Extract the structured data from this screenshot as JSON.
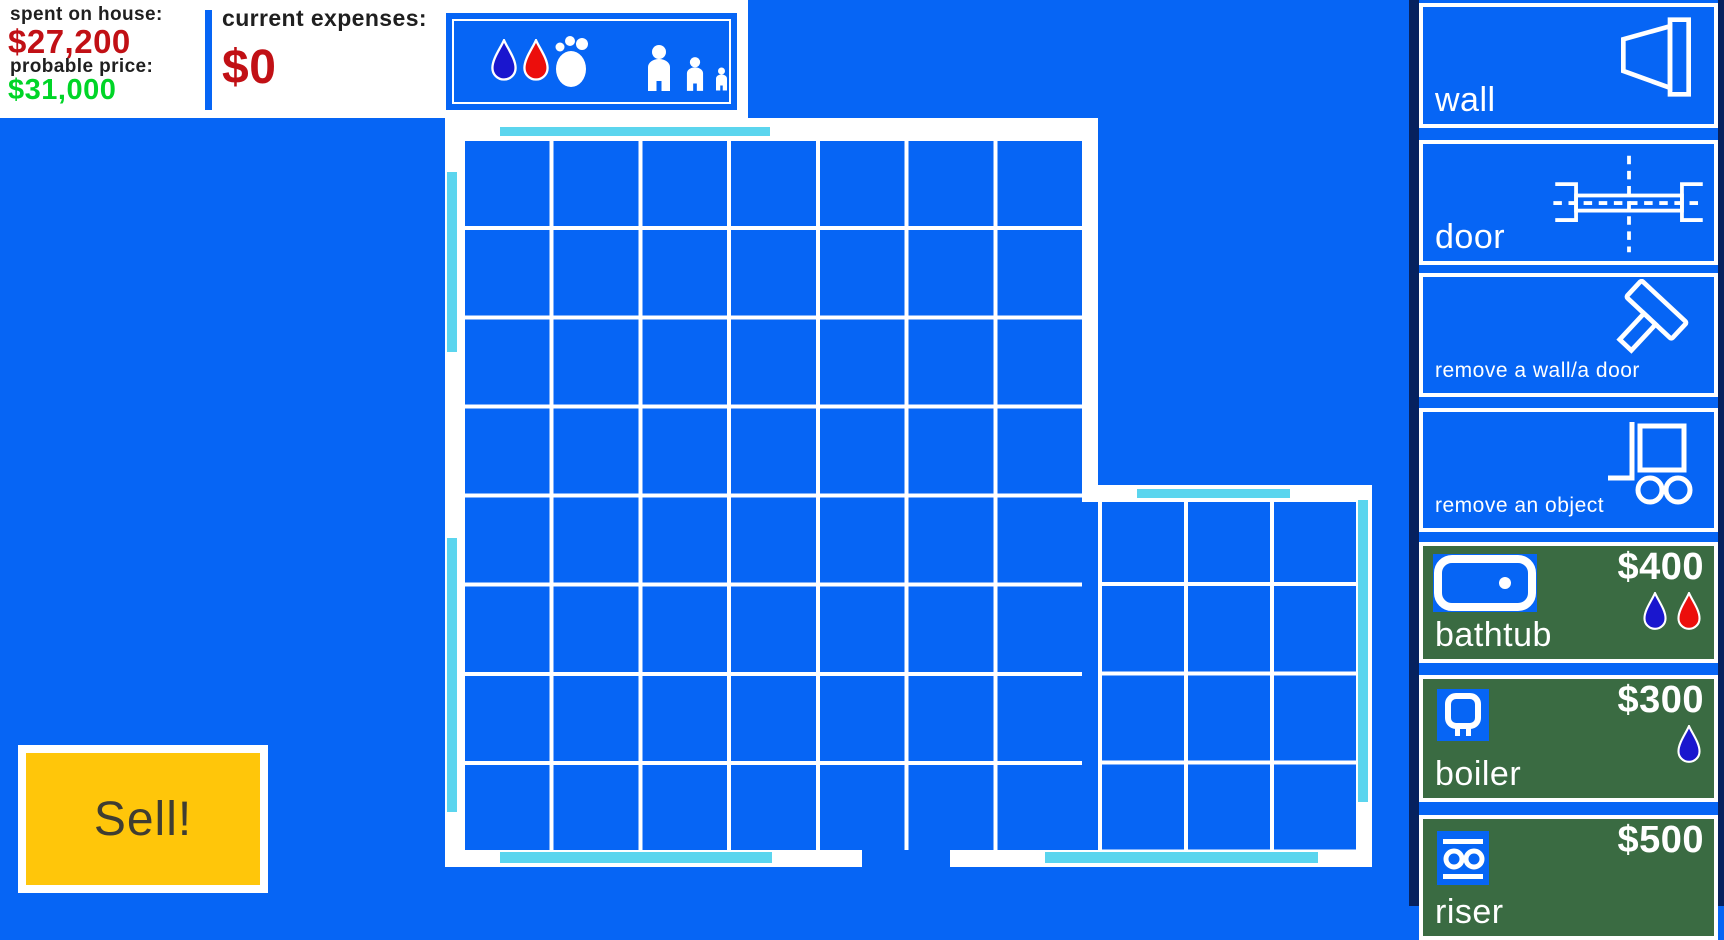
{
  "colors": {
    "background_blue": "#0665F5",
    "wall_white": "#FFFFFF",
    "window_cyan": "#5BD5EE",
    "item_green": "#3A6B42",
    "sell_yellow": "#FFC60A",
    "spent_red": "#C11015",
    "price_green": "#00D527",
    "cold_water_blue": "#1A16CE",
    "hot_water_red": "#EC0E0C",
    "sidebar_edge_navy": "#06215E"
  },
  "stats_panel": {
    "spent_label": "spent on house:",
    "spent_value": "$27,200",
    "price_label": "probable price:",
    "price_value": "$31,000",
    "expenses_label": "current expenses:",
    "expenses_value": "$0"
  },
  "indicator_panel": {
    "icons": [
      "cold-water-drop-icon",
      "hot-water-drop-icon",
      "footprint-icon",
      "person-large-icon",
      "person-medium-icon",
      "person-small-icon"
    ]
  },
  "sell_button": {
    "label": "Sell!"
  },
  "sidebar": {
    "buttons": [
      {
        "id": "wall",
        "type": "tool",
        "label": "wall",
        "icon": "wall-icon"
      },
      {
        "id": "door",
        "type": "tool",
        "label": "door",
        "icon": "door-icon"
      },
      {
        "id": "remove-wall-door",
        "type": "tool",
        "label": "remove a wall/a door",
        "icon": "hammer-icon"
      },
      {
        "id": "remove-object",
        "type": "tool",
        "label": "remove an object",
        "icon": "hand-truck-icon"
      },
      {
        "id": "bathtub",
        "type": "item",
        "label": "bathtub",
        "price": "$400",
        "icon": "bathtub-icon",
        "requires": [
          "cold-water",
          "hot-water"
        ]
      },
      {
        "id": "boiler",
        "type": "item",
        "label": "boiler",
        "price": "$300",
        "icon": "boiler-icon",
        "requires": [
          "cold-water"
        ]
      },
      {
        "id": "riser",
        "type": "item",
        "label": "riser",
        "price": "$500",
        "icon": "riser-icon",
        "requires": []
      }
    ]
  }
}
